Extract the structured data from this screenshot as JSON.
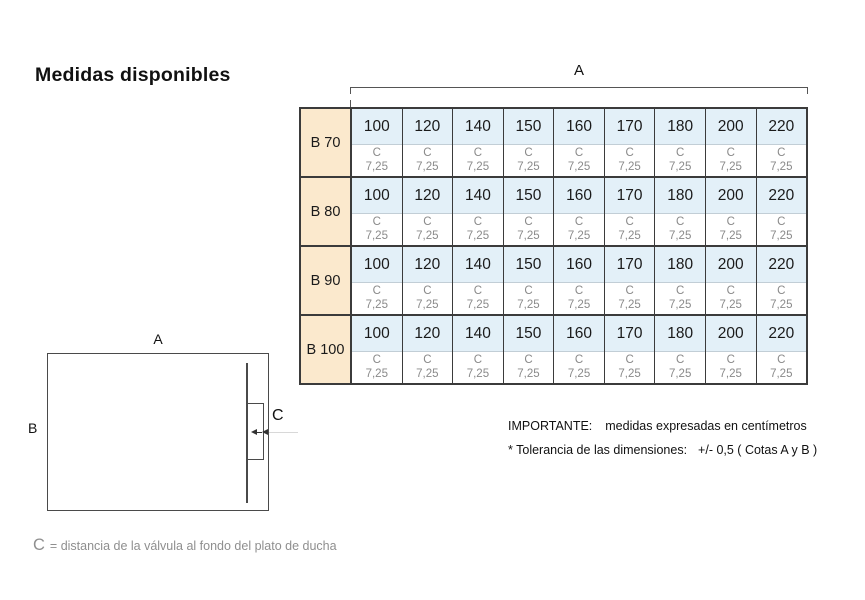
{
  "title": "Medidas disponibles",
  "dimension_bracket": {
    "label": "A"
  },
  "table": {
    "rows": [
      {
        "label": "B 70",
        "cells": [
          {
            "size": "100",
            "c_label": "C",
            "c_value": "7,25"
          },
          {
            "size": "120",
            "c_label": "C",
            "c_value": "7,25"
          },
          {
            "size": "140",
            "c_label": "C",
            "c_value": "7,25"
          },
          {
            "size": "150",
            "c_label": "C",
            "c_value": "7,25"
          },
          {
            "size": "160",
            "c_label": "C",
            "c_value": "7,25"
          },
          {
            "size": "170",
            "c_label": "C",
            "c_value": "7,25"
          },
          {
            "size": "180",
            "c_label": "C",
            "c_value": "7,25"
          },
          {
            "size": "200",
            "c_label": "C",
            "c_value": "7,25"
          },
          {
            "size": "220",
            "c_label": "C",
            "c_value": "7,25"
          }
        ]
      },
      {
        "label": "B 80",
        "cells": [
          {
            "size": "100",
            "c_label": "C",
            "c_value": "7,25"
          },
          {
            "size": "120",
            "c_label": "C",
            "c_value": "7,25"
          },
          {
            "size": "140",
            "c_label": "C",
            "c_value": "7,25"
          },
          {
            "size": "150",
            "c_label": "C",
            "c_value": "7,25"
          },
          {
            "size": "160",
            "c_label": "C",
            "c_value": "7,25"
          },
          {
            "size": "170",
            "c_label": "C",
            "c_value": "7,25"
          },
          {
            "size": "180",
            "c_label": "C",
            "c_value": "7,25"
          },
          {
            "size": "200",
            "c_label": "C",
            "c_value": "7,25"
          },
          {
            "size": "220",
            "c_label": "C",
            "c_value": "7,25"
          }
        ]
      },
      {
        "label": "B 90",
        "cells": [
          {
            "size": "100",
            "c_label": "C",
            "c_value": "7,25"
          },
          {
            "size": "120",
            "c_label": "C",
            "c_value": "7,25"
          },
          {
            "size": "140",
            "c_label": "C",
            "c_value": "7,25"
          },
          {
            "size": "150",
            "c_label": "C",
            "c_value": "7,25"
          },
          {
            "size": "160",
            "c_label": "C",
            "c_value": "7,25"
          },
          {
            "size": "170",
            "c_label": "C",
            "c_value": "7,25"
          },
          {
            "size": "180",
            "c_label": "C",
            "c_value": "7,25"
          },
          {
            "size": "200",
            "c_label": "C",
            "c_value": "7,25"
          },
          {
            "size": "220",
            "c_label": "C",
            "c_value": "7,25"
          }
        ]
      },
      {
        "label": "B 100",
        "cells": [
          {
            "size": "100",
            "c_label": "C",
            "c_value": "7,25"
          },
          {
            "size": "120",
            "c_label": "C",
            "c_value": "7,25"
          },
          {
            "size": "140",
            "c_label": "C",
            "c_value": "7,25"
          },
          {
            "size": "150",
            "c_label": "C",
            "c_value": "7,25"
          },
          {
            "size": "160",
            "c_label": "C",
            "c_value": "7,25"
          },
          {
            "size": "170",
            "c_label": "C",
            "c_value": "7,25"
          },
          {
            "size": "180",
            "c_label": "C",
            "c_value": "7,25"
          },
          {
            "size": "200",
            "c_label": "C",
            "c_value": "7,25"
          },
          {
            "size": "220",
            "c_label": "C",
            "c_value": "7,25"
          }
        ]
      }
    ]
  },
  "diagram": {
    "a_label": "A",
    "b_label": "B",
    "c_label": "C"
  },
  "caption": {
    "c_symbol": "C",
    "text": "= distancia de la válvula al fondo del plato de ducha"
  },
  "notes": {
    "importante_label": "IMPORTANTE:",
    "importante_text": "medidas expresadas en centímetros",
    "tolerancia_label": "*  Tolerancia de las dimensiones:",
    "tolerancia_value": "+/- 0,5 ( Cotas A y B )"
  },
  "colors": {
    "row_header_fill": "#fbe9cd",
    "size_cell_fill": "#e3f0f8",
    "table_border": "#3b3b3b",
    "muted_text": "#8a8a8a"
  }
}
